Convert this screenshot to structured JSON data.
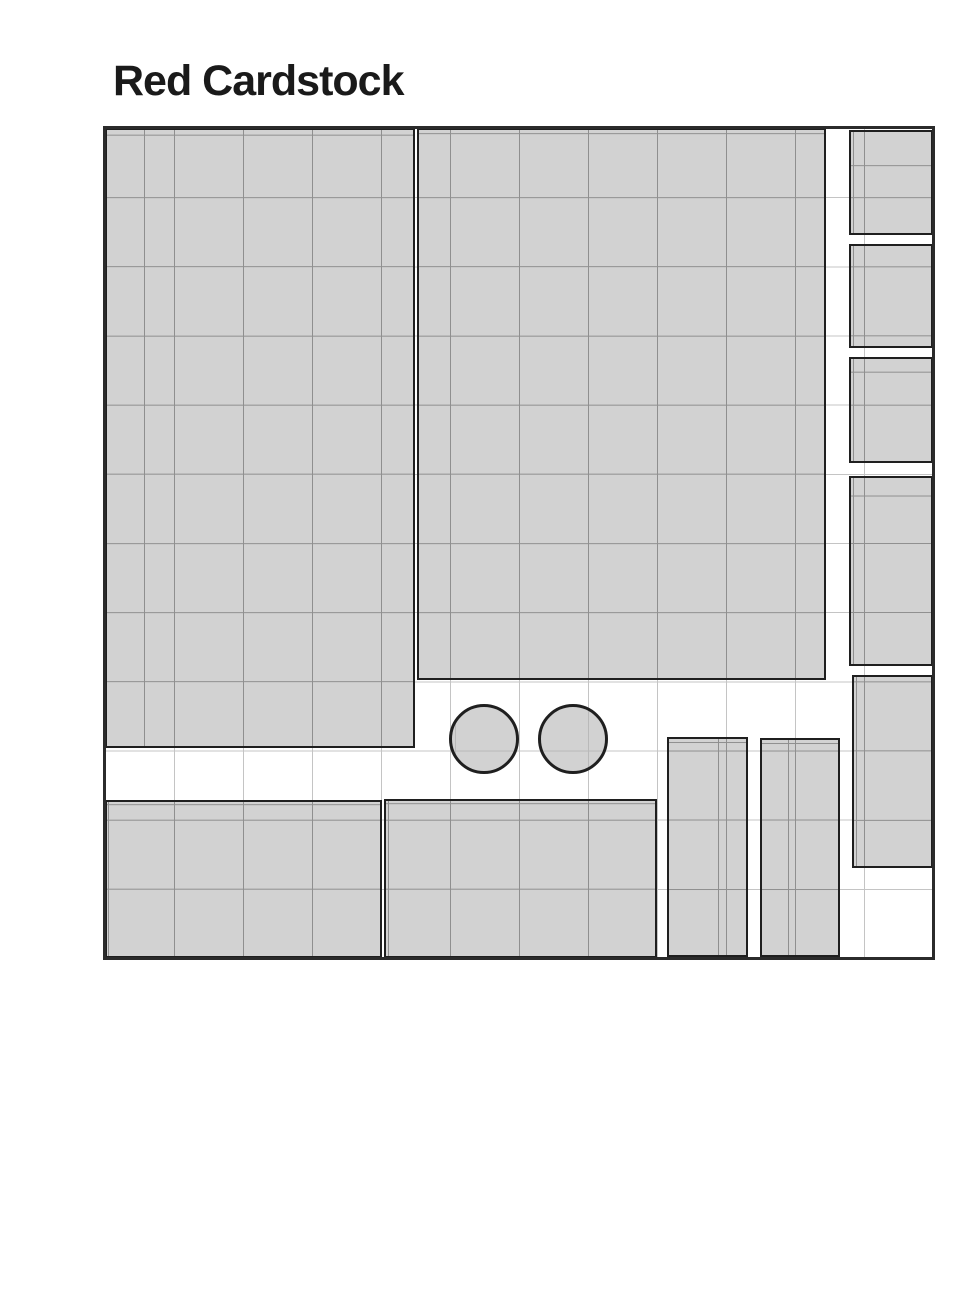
{
  "title": "Red Cardstock",
  "colors": {
    "background": "#ffffff",
    "title_color": "#1a1a1a",
    "piece_fill": "#d2d2d2",
    "piece_border": "#1f1f1f",
    "sheet_outline": "#2b2b2b",
    "grid_line_light": "#c4c4c4",
    "grid_line_on_piece": "#8f8f8f",
    "grid_line_on_circle": "#b9b9b9"
  },
  "sheet": {
    "x": 105,
    "y": 128,
    "width": 828,
    "height": 830,
    "grid_cols": 12,
    "grid_rows": 12,
    "cell_width": 69,
    "cell_height": 69.17
  },
  "pieces": [
    {
      "id": "large-left",
      "shape": "rect",
      "x": 0,
      "y": 0,
      "w": 310,
      "h": 620
    },
    {
      "id": "large-middle",
      "shape": "rect",
      "x": 312,
      "y": 0,
      "w": 409,
      "h": 552
    },
    {
      "id": "right-column-1",
      "shape": "rect",
      "x": 744,
      "y": 2,
      "w": 84,
      "h": 105
    },
    {
      "id": "right-column-2",
      "shape": "rect",
      "x": 744,
      "y": 116,
      "w": 84,
      "h": 104
    },
    {
      "id": "right-column-3",
      "shape": "rect",
      "x": 744,
      "y": 229,
      "w": 84,
      "h": 106
    },
    {
      "id": "right-column-4",
      "shape": "rect",
      "x": 744,
      "y": 348,
      "w": 84,
      "h": 190
    },
    {
      "id": "right-column-5",
      "shape": "rect",
      "x": 747,
      "y": 547,
      "w": 81,
      "h": 193
    },
    {
      "id": "bottom-left",
      "shape": "rect",
      "x": 0,
      "y": 672,
      "w": 277,
      "h": 158
    },
    {
      "id": "bottom-middle",
      "shape": "rect",
      "x": 279,
      "y": 671,
      "w": 273,
      "h": 159
    },
    {
      "id": "bottom-vertical-1",
      "shape": "rect",
      "x": 562,
      "y": 609,
      "w": 81,
      "h": 220
    },
    {
      "id": "bottom-vertical-2",
      "shape": "rect",
      "x": 655,
      "y": 610,
      "w": 80,
      "h": 219
    },
    {
      "id": "circle-1",
      "shape": "circle",
      "cx": 379,
      "cy": 611,
      "r": 35
    },
    {
      "id": "circle-2",
      "shape": "circle",
      "cx": 468,
      "cy": 611,
      "r": 35
    }
  ]
}
